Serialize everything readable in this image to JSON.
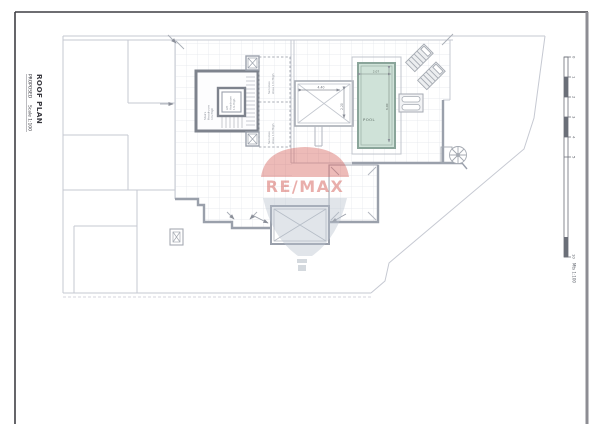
{
  "sheet": {
    "title": "ROOF PLAN",
    "subtitle_status": "PROPOSED",
    "subtitle_scale": "Scale 1:100"
  },
  "plan": {
    "stairs_label": [
      "Stairs",
      "Headroom",
      "1m High"
    ],
    "lift_label": [
      "Lift",
      "Headroom",
      "1m High"
    ],
    "services_top_label": [
      "Services",
      "Area 1m High"
    ],
    "services_bottom_label": [
      "Services",
      "Area 1m High"
    ],
    "pool_label": "POOL",
    "dims": {
      "skylight_width": "4.40",
      "skylight_height": "2.20",
      "pool_width": "2.07",
      "pool_length": "6.00"
    }
  },
  "watermark": {
    "brand": "RE/MAX"
  },
  "scalebar": {
    "ticks": [
      "0",
      "1",
      "2",
      "3",
      "4",
      "5",
      "10"
    ],
    "unit": "Mts 1:100"
  },
  "colors": {
    "pool_fill": "#cfe2d8",
    "pool_edge": "#8aa59a",
    "remax_red": "#cc4038",
    "balloon_blue": "#b9c3cf",
    "line_light": "#c6c9d2",
    "line_mid": "#9aa0ab",
    "line_dark": "#7e838d",
    "sheet_border": "#3f3f44"
  }
}
